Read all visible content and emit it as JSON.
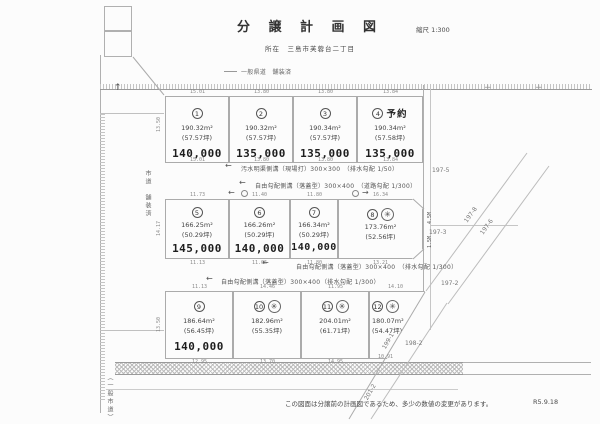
{
  "header": {
    "title": "分 譲 計 画 図",
    "scale": "縮尺 1:300",
    "location": "所在　三島市芙蓉台二丁目"
  },
  "roads": {
    "top_label": "一般県道　舗装済",
    "left_label": "市道　舗装済",
    "bottom_label": "（一般市道）"
  },
  "drain_notes": {
    "s1l1": "汚水明渠側溝（現場打）300×300　（排水勾配 1/50）",
    "s1l2": "自由勾配側溝（落蓋型）300×400　（道路勾配 1/300）",
    "s2l1": "自由勾配側溝（落蓋型）300×400　（排水勾配 1/300）",
    "s2l2a": "自由勾配側溝（落蓋型）300×400",
    "s2l2b": "（排水勾配 1/300）"
  },
  "lots": [
    {
      "num": "1",
      "reserved": "",
      "stamp": "",
      "area": "190.32m²",
      "tsubo": "(57.57坪)",
      "price": "140,000"
    },
    {
      "num": "2",
      "reserved": "",
      "stamp": "",
      "area": "190.32m²",
      "tsubo": "(57.57坪)",
      "price": "135,000"
    },
    {
      "num": "3",
      "reserved": "",
      "stamp": "",
      "area": "190.34m²",
      "tsubo": "(57.57坪)",
      "price": "135,000"
    },
    {
      "num": "4",
      "reserved": "予約",
      "stamp": "",
      "area": "190.34m²",
      "tsubo": "(57.58坪)",
      "price": "135,000"
    },
    {
      "num": "5",
      "reserved": "",
      "stamp": "",
      "area": "166.25m²",
      "tsubo": "(50.29坪)",
      "price": "145,000"
    },
    {
      "num": "6",
      "reserved": "",
      "stamp": "",
      "area": "166.26m²",
      "tsubo": "(50.29坪)",
      "price": "140,000"
    },
    {
      "num": "7",
      "reserved": "",
      "stamp": "",
      "area": "166.34m²",
      "tsubo": "(50.29坪)",
      "price": "140,000"
    },
    {
      "num": "8",
      "reserved": "",
      "stamp": "✳",
      "area": "173.76m²",
      "tsubo": "(52.56坪)",
      "price": ""
    },
    {
      "num": "9",
      "reserved": "",
      "stamp": "",
      "area": "186.64m²",
      "tsubo": "(56.45坪)",
      "price": "140,000"
    },
    {
      "num": "10",
      "reserved": "",
      "stamp": "✳",
      "area": "182.96m²",
      "tsubo": "(55.35坪)",
      "price": ""
    },
    {
      "num": "11",
      "reserved": "",
      "stamp": "✳",
      "area": "204.01m²",
      "tsubo": "(61.71坪)",
      "price": ""
    },
    {
      "num": "12",
      "reserved": "",
      "stamp": "✳",
      "area": "180.07m²",
      "tsubo": "(54.47坪)",
      "price": ""
    }
  ],
  "dims": {
    "r1t": [
      "15.01",
      "13.80",
      "13.80",
      "13.84"
    ],
    "r1b": [
      "15.01",
      "13.80",
      "13.80",
      "13.84"
    ],
    "r2t": [
      "11.73",
      "11.40",
      "11.80",
      "16.34"
    ],
    "r2b": [
      "11.13",
      "11.06",
      "11.80",
      "13.21"
    ],
    "r3t": [
      "11.13",
      "14.46",
      "11.95",
      "14.10"
    ],
    "r3b": [
      "12.95",
      "13.70",
      "14.95",
      "10.91"
    ],
    "side": [
      "13.50",
      "14.17",
      "13.50"
    ],
    "v1": "4.5M",
    "v2": "1.5M"
  },
  "parcels": {
    "p1": "197-5",
    "p2": "197-3",
    "p3": "197-2",
    "p4": "198-2",
    "d1": "197-8",
    "d2": "197-6",
    "d3": "199-1",
    "d4": "201-2"
  },
  "flow": {
    "left": "←",
    "right": "→",
    "up": "↑"
  },
  "marks": {
    "cross": "+"
  },
  "footer": {
    "note": "この図面は分譲前の計画図であるため、多少の数値の変更があります。",
    "date": "R5.9.18"
  },
  "colors": {
    "paper": "#fcfcfc",
    "line": "#b0b0b0",
    "ink": "#3a3a3a"
  }
}
